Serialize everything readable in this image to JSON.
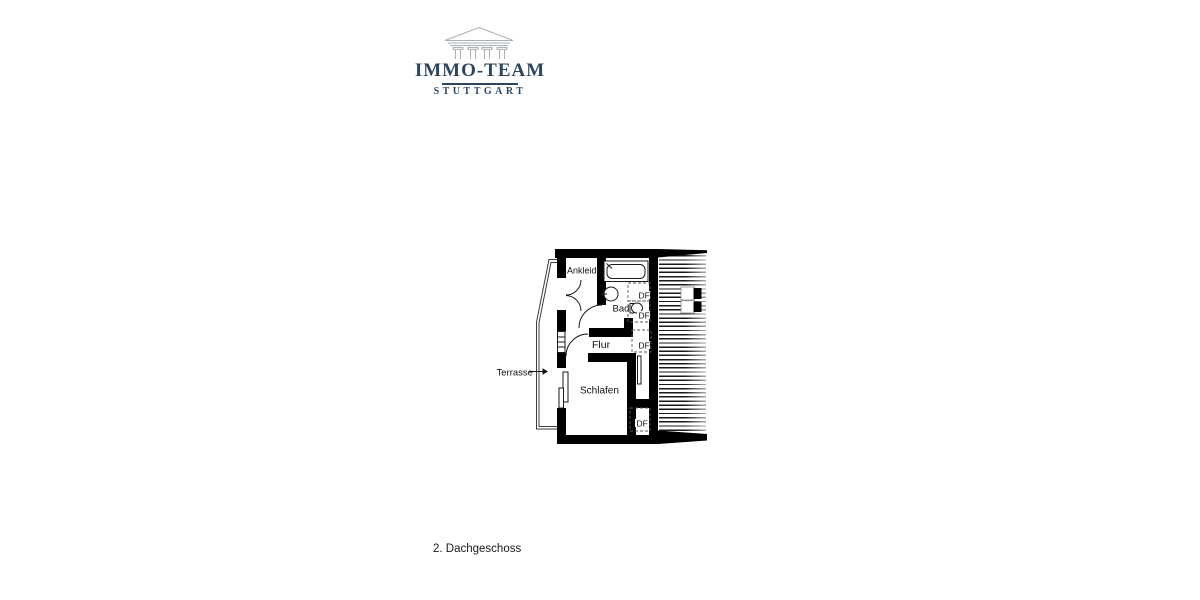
{
  "logo": {
    "title": "IMMO-TEAM",
    "subtitle": "STUTTGART",
    "brand_color": "#2c4660",
    "icon": "temple-pediment-icon"
  },
  "plan": {
    "caption": "2. Dachgeschoss",
    "labels": {
      "ankleide": "Ankleide",
      "bad": "Bad",
      "flur": "Flur",
      "schlafen": "Schlafen",
      "terrasse": "Terrasse",
      "roof_window": "DF"
    },
    "colors": {
      "wall": "#000000",
      "dashed_line": "#5a5a5a",
      "label": "#111111"
    }
  }
}
